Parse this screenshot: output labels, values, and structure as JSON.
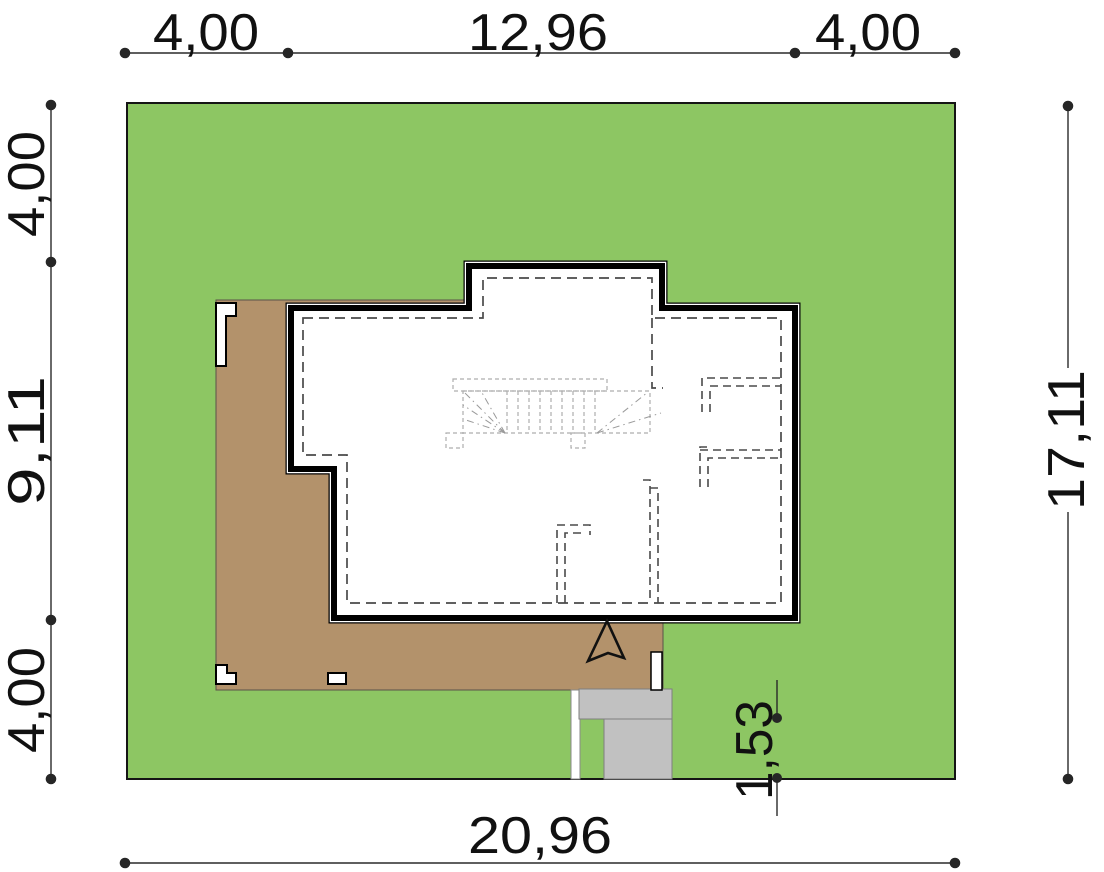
{
  "dimensions": {
    "top_left": "4,00",
    "top_middle": "12,96",
    "top_right": "4,00",
    "left_top": "4,00",
    "left_middle": "9,11",
    "left_bottom": "4,00",
    "right_total": "17,11",
    "bottom_total": "20,96",
    "driveway_depth": "1,53"
  },
  "colors": {
    "grass": "#8DC663",
    "terrace": "#B3926B",
    "driveway": "#C1C1C1",
    "house_fill": "#FFFFFF"
  }
}
